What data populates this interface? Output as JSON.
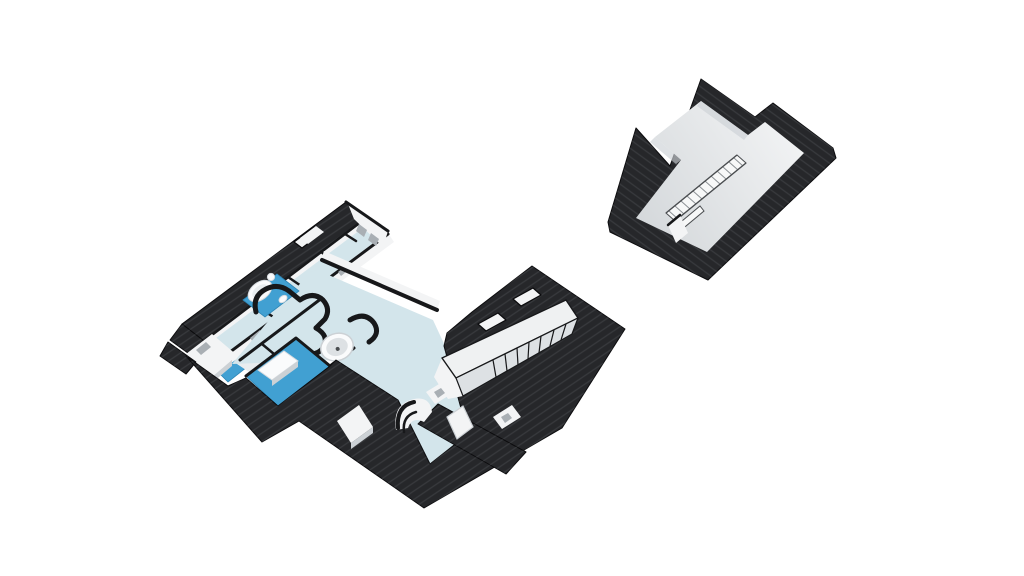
{
  "scene": {
    "background": "#ffffff",
    "render": "isometric-3d-floorplan",
    "buildings": [
      {
        "name": "main-building-attic-level",
        "features": [
          "blue-bathroom-floors",
          "round-jacuzzi",
          "bathtubs",
          "roof-skylights",
          "sloped-ceiling-volume"
        ]
      },
      {
        "name": "secondary-building-attic-level",
        "features": [
          "stair-railing",
          "open-gray-floor"
        ]
      }
    ],
    "counts": {
      "skylights": 3,
      "blue-floor-areas": 4,
      "jacuzzi": 1,
      "railings": 1
    }
  },
  "colors": {
    "background": "#ffffff",
    "roof-dark": "#26272a",
    "roof-stripe": "#4a4b50",
    "roof-edge": "#0b0b0d",
    "wall-cut": "#17181a",
    "wall-white": "#f3f4f5",
    "wall-shade": "#ccd1d5",
    "window-slit": "#a9afb4",
    "floor-pale": "#d3e5eb",
    "floor-room": "#e9edef",
    "floor-blue": "#41a0d2",
    "floor-blue-deep": "#2e86b6",
    "volume-top": "#eff1f2",
    "volume-face": "#dde1e4",
    "b-floor-a": "#d2d6d9",
    "b-floor-b": "#f4f5f6",
    "railing": "#f7f8f8",
    "railing-edge": "#4a4d50",
    "railing-tick": "#8b9094",
    "fixture": "#fafbfc",
    "fixture-shade": "#d8dce0"
  }
}
